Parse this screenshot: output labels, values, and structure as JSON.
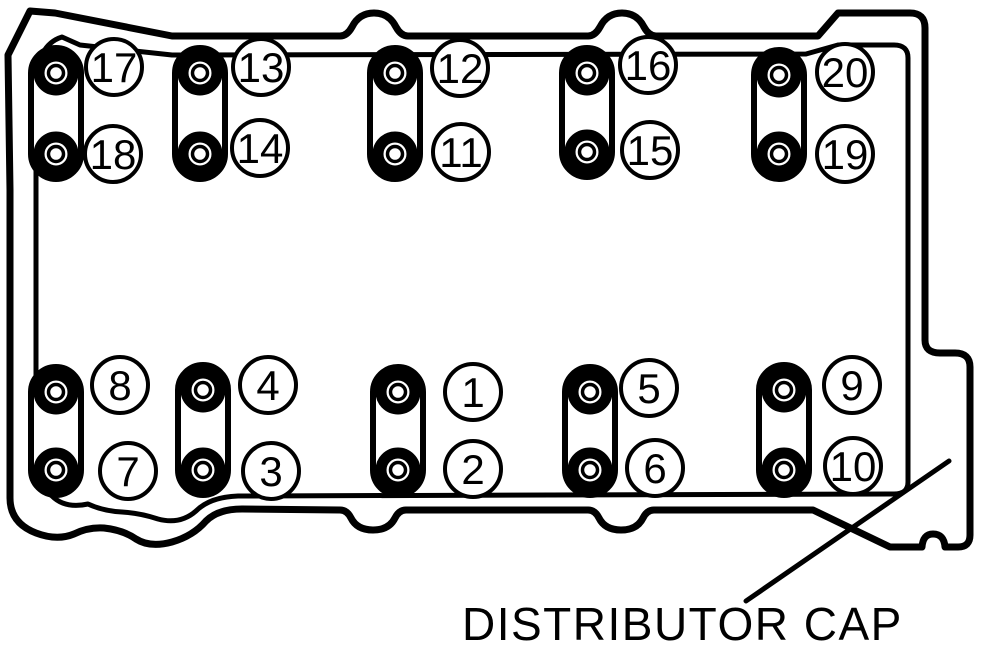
{
  "diagram": {
    "type": "cylinder-head-bolt-torque-sequence",
    "background": "#ffffff",
    "ink": "#000000",
    "callout": {
      "text": "DISTRIBUTOR CAP"
    },
    "sequence_count": 20,
    "slots": [
      {
        "x": 56,
        "y1": 73,
        "y2": 154,
        "row": "top"
      },
      {
        "x": 200,
        "y1": 73,
        "y2": 154,
        "row": "top"
      },
      {
        "x": 395,
        "y1": 73,
        "y2": 154,
        "row": "top"
      },
      {
        "x": 587,
        "y1": 73,
        "y2": 152,
        "row": "top"
      },
      {
        "x": 779,
        "y1": 75,
        "y2": 154,
        "row": "top"
      },
      {
        "x": 56,
        "y1": 392,
        "y2": 470,
        "row": "bottom"
      },
      {
        "x": 203,
        "y1": 390,
        "y2": 470,
        "row": "bottom"
      },
      {
        "x": 398,
        "y1": 392,
        "y2": 470,
        "row": "bottom"
      },
      {
        "x": 590,
        "y1": 392,
        "y2": 470,
        "row": "bottom"
      },
      {
        "x": 784,
        "y1": 390,
        "y2": 470,
        "row": "bottom"
      }
    ],
    "bolts": [
      {
        "seq": "17",
        "cx": 56,
        "cy": 73,
        "lx": 114,
        "ly": 67
      },
      {
        "seq": "18",
        "cx": 56,
        "cy": 154,
        "lx": 113,
        "ly": 154
      },
      {
        "seq": "13",
        "cx": 200,
        "cy": 73,
        "lx": 261,
        "ly": 67
      },
      {
        "seq": "14",
        "cx": 200,
        "cy": 154,
        "lx": 260,
        "ly": 148
      },
      {
        "seq": "12",
        "cx": 395,
        "cy": 73,
        "lx": 460,
        "ly": 68
      },
      {
        "seq": "11",
        "cx": 395,
        "cy": 154,
        "lx": 461,
        "ly": 152
      },
      {
        "seq": "16",
        "cx": 587,
        "cy": 73,
        "lx": 648,
        "ly": 65
      },
      {
        "seq": "15",
        "cx": 587,
        "cy": 152,
        "lx": 650,
        "ly": 150
      },
      {
        "seq": "20",
        "cx": 779,
        "cy": 75,
        "lx": 845,
        "ly": 72
      },
      {
        "seq": "19",
        "cx": 779,
        "cy": 154,
        "lx": 845,
        "ly": 154
      },
      {
        "seq": "8",
        "cx": 56,
        "cy": 392,
        "lx": 120,
        "ly": 385
      },
      {
        "seq": "7",
        "cx": 56,
        "cy": 470,
        "lx": 128,
        "ly": 471
      },
      {
        "seq": "4",
        "cx": 203,
        "cy": 390,
        "lx": 268,
        "ly": 385
      },
      {
        "seq": "3",
        "cx": 203,
        "cy": 470,
        "lx": 271,
        "ly": 471
      },
      {
        "seq": "1",
        "cx": 398,
        "cy": 392,
        "lx": 473,
        "ly": 392
      },
      {
        "seq": "2",
        "cx": 398,
        "cy": 470,
        "lx": 473,
        "ly": 469
      },
      {
        "seq": "5",
        "cx": 590,
        "cy": 392,
        "lx": 649,
        "ly": 388
      },
      {
        "seq": "6",
        "cx": 590,
        "cy": 470,
        "lx": 655,
        "ly": 468
      },
      {
        "seq": "9",
        "cx": 784,
        "cy": 390,
        "lx": 852,
        "ly": 385
      },
      {
        "seq": "10",
        "cx": 784,
        "cy": 470,
        "lx": 853,
        "ly": 466
      }
    ]
  }
}
